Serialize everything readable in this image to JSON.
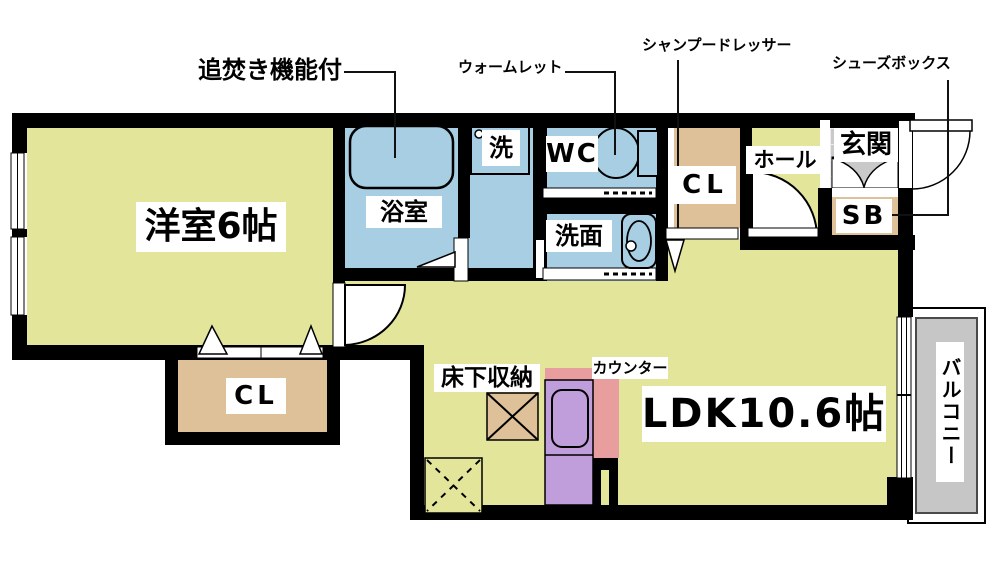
{
  "floorplan": {
    "rooms": {
      "western_room": "洋室6帖",
      "bathroom": "浴室",
      "laundry": "洗",
      "toilet": "WC",
      "washroom": "洗面",
      "closet_upper": "CL",
      "hall": "ホール",
      "entrance": "玄関",
      "shoe_box": "SB",
      "closet_lower": "CL",
      "ldk": "LDK10.6帖",
      "balcony": "バルコニー",
      "underfloor_storage": "床下収納",
      "counter": "カウンター"
    },
    "annotations": {
      "reheating_function": "追焚き機能付",
      "warmlet": "ウォームレット",
      "shampoo_dresser": "シャンプードレッサー",
      "shoes_box": "シューズボックス"
    },
    "colors": {
      "floor_yellow": "#e2e59a",
      "wet_area_blue": "#a8cee3",
      "closet_tan": "#dec198",
      "kitchen_purple": "#c09ddb",
      "counter_pink": "#e89e9e",
      "entrance_tile_gray": "#c9c9c9",
      "balcony_gray": "#c6c6c6",
      "wall_black": "#000000"
    }
  }
}
